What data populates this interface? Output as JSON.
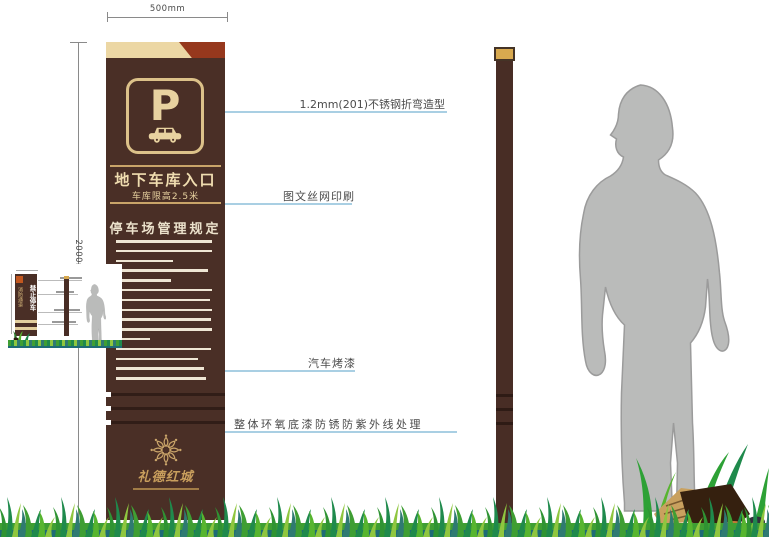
{
  "dimensions": {
    "width_label": "500mm",
    "height_label": "2000mm"
  },
  "sign": {
    "parking_letter": "P",
    "entrance_title": "地下车库入口",
    "entrance_subtitle": "车库限高2.5米",
    "rules_title": "停车场管理规定",
    "logo_text": "礼德红城",
    "rule_line_widths_pct": [
      96,
      96,
      57,
      92,
      55,
      96,
      94,
      96,
      95,
      96,
      34,
      95,
      82,
      88,
      90
    ]
  },
  "annotations": {
    "steel": "1.2mm(201)不锈钢折弯造型",
    "print": "图文丝网印刷",
    "paint": "汽车烤漆",
    "primer": "整体环氧底漆防锈防紫外线处理"
  },
  "thumbnail": {
    "sign_text_right": "禁止停车",
    "sign_text_left": "消防通道"
  },
  "colors": {
    "sign_brown": "#4a2f26",
    "band_cream": "#ecd7a4",
    "accent_maroon": "#96381d",
    "gold": "#c9a469",
    "cream_text": "#f0ddb0",
    "leader_blue": "#a9cfe3",
    "annotation_text": "#4b4b4b",
    "person_gray": "#babbba",
    "grass_dark_teal": "#1e6b76"
  }
}
